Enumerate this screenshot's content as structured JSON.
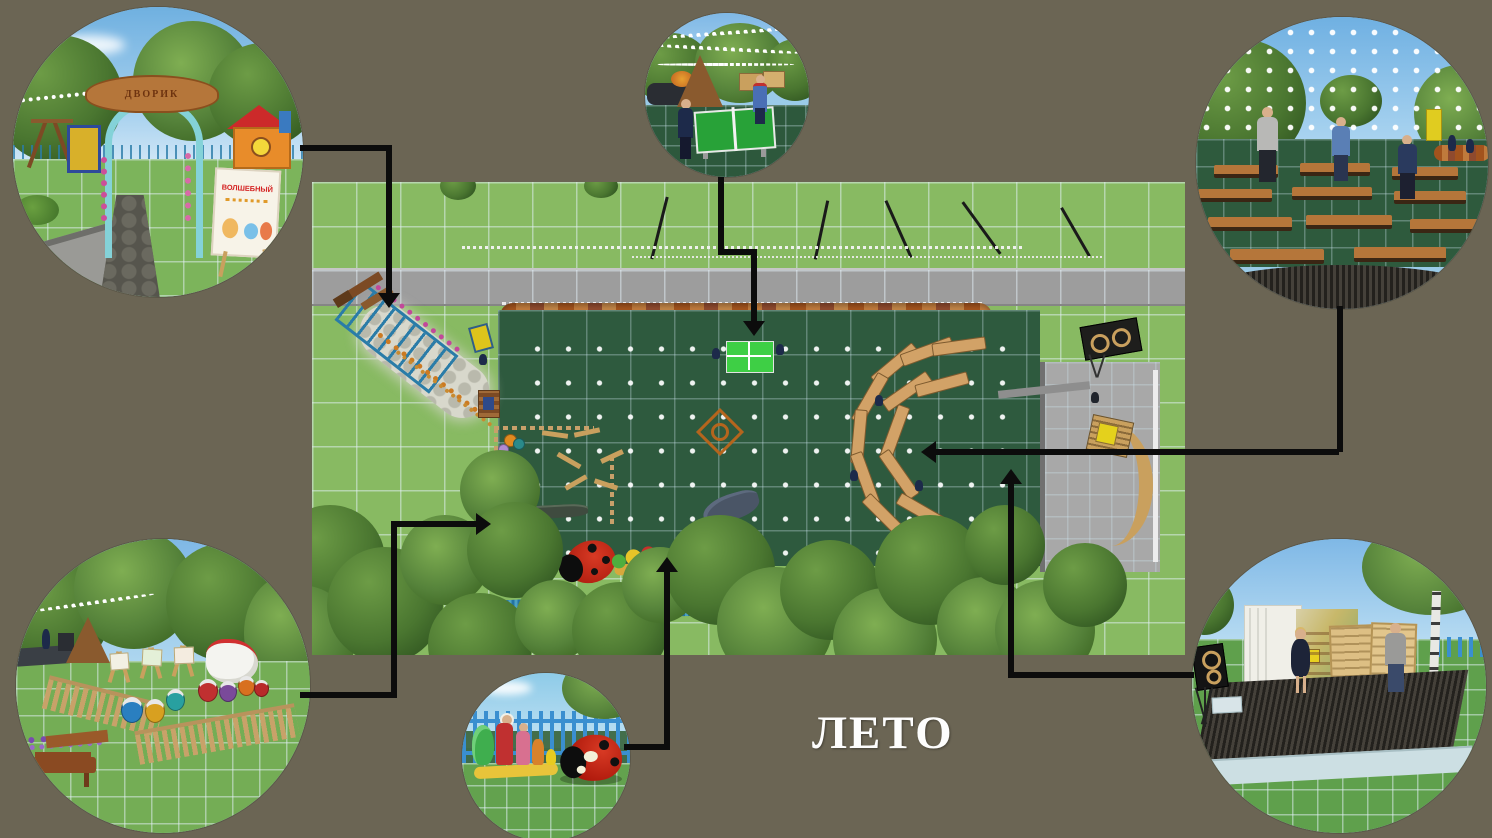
{
  "slide": {
    "title": "ЛЕТО",
    "background_color": "#6b6554",
    "title_color": "#fdfdfd",
    "connector_color": "#0c0c0c"
  },
  "plan": {
    "label": "top-down summer site plan",
    "features": [
      "lawn-grid",
      "road",
      "hedge-row",
      "event-lawn",
      "entrance-arch",
      "pergola-path",
      "flower-borders",
      "info-sign",
      "art-corner-fence",
      "paint-drums",
      "easels",
      "crocodile-bench",
      "ping-pong-table",
      "compass-ornament",
      "bench-rows",
      "stage",
      "speaker",
      "ramp",
      "ladybug-playhouse",
      "fairy-tale-figures",
      "blue-mats",
      "string-lights",
      "trees"
    ]
  },
  "callouts": {
    "entrance": {
      "label": "park entrance arch and magic sign",
      "arch_text": "ДВОРИК",
      "sign_title": "ВОЛШЕБНЫЙ"
    },
    "ping_pong": {
      "label": "ping-pong table under string lights"
    },
    "audience": {
      "label": "bench seating area seen from stage"
    },
    "art_corner": {
      "label": "creative corner with easels and paint drums"
    },
    "fairytale": {
      "label": "fairy-tale figures and ladybug playhouse"
    },
    "stage": {
      "label": "summer stage with wooden backdrop"
    }
  }
}
